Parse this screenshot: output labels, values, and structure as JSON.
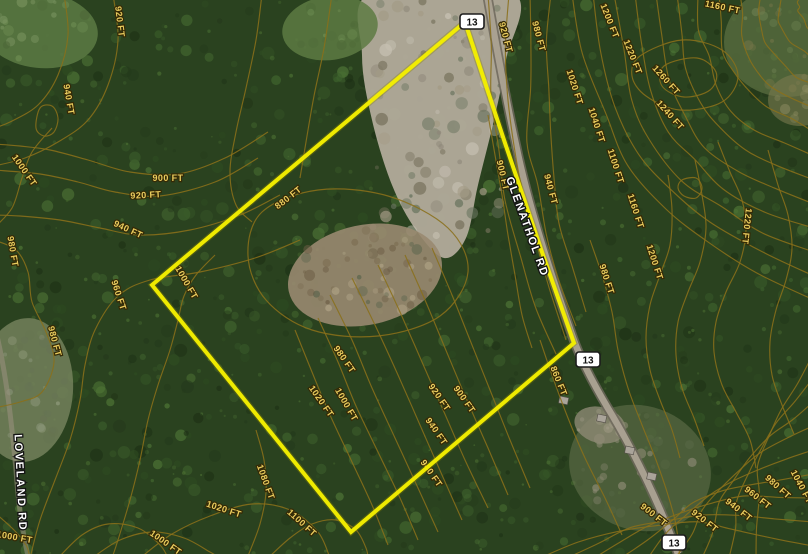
{
  "map": {
    "kind": "satellite-topographic-parcel-map",
    "elevation_unit": "FT",
    "colors": {
      "forest_base": "#2a421f",
      "contour_line": "#8a701a",
      "contour_label_fill": "#e9cc5e",
      "contour_label_outline": "#352a06",
      "boundary_yellow": "#f4ee00",
      "road_fill": "#aca393",
      "road_casing": "#6d675c",
      "shield_fill": "#ffffff",
      "shield_border": "#1c1c1c"
    },
    "route_markers": [
      {
        "text": "13",
        "x": 472,
        "y": 22
      },
      {
        "text": "13",
        "x": 588,
        "y": 360
      },
      {
        "text": "13",
        "x": 674,
        "y": 543
      }
    ],
    "road_labels": [
      {
        "text": "GLENATHOL RD",
        "x": 524,
        "y": 228,
        "rot": 70
      },
      {
        "text": "LOVELAND RD",
        "x": 17,
        "y": 483,
        "rot": 87
      }
    ],
    "boundary": {
      "points": [
        [
          465,
          22
        ],
        [
          505,
          143
        ],
        [
          543,
          255
        ],
        [
          574,
          343
        ],
        [
          351,
          532
        ],
        [
          152,
          285
        ]
      ]
    },
    "contour_labels": [
      {
        "text": "920 FT",
        "x": 117,
        "y": 22,
        "rot": 83
      },
      {
        "text": "940 FT",
        "x": 66,
        "y": 100,
        "rot": 80
      },
      {
        "text": "1000 FT",
        "x": 22,
        "y": 172,
        "rot": 55
      },
      {
        "text": "900 FT",
        "x": 168,
        "y": 181,
        "rot": 0
      },
      {
        "text": "920 FT",
        "x": 146,
        "y": 198,
        "rot": -3
      },
      {
        "text": "940 FT",
        "x": 127,
        "y": 232,
        "rot": 25
      },
      {
        "text": "960 FT",
        "x": 116,
        "y": 296,
        "rot": 72
      },
      {
        "text": "1000 FT",
        "x": 184,
        "y": 284,
        "rot": 60
      },
      {
        "text": "980 FT",
        "x": 10,
        "y": 252,
        "rot": 80
      },
      {
        "text": "980 FT",
        "x": 52,
        "y": 342,
        "rot": 75
      },
      {
        "text": "880 FT",
        "x": 290,
        "y": 200,
        "rot": -38
      },
      {
        "text": "900 FT",
        "x": 500,
        "y": 176,
        "rot": 77
      },
      {
        "text": "940 FT",
        "x": 548,
        "y": 190,
        "rot": 75
      },
      {
        "text": "920 FT",
        "x": 503,
        "y": 38,
        "rot": 75
      },
      {
        "text": "980 FT",
        "x": 536,
        "y": 37,
        "rot": 75
      },
      {
        "text": "1020 FT",
        "x": 572,
        "y": 88,
        "rot": 72
      },
      {
        "text": "1040 FT",
        "x": 594,
        "y": 126,
        "rot": 72
      },
      {
        "text": "1100 FT",
        "x": 613,
        "y": 167,
        "rot": 72
      },
      {
        "text": "1160 FT",
        "x": 633,
        "y": 212,
        "rot": 72
      },
      {
        "text": "1200 FT",
        "x": 652,
        "y": 263,
        "rot": 72
      },
      {
        "text": "1200 FT",
        "x": 607,
        "y": 22,
        "rot": 68
      },
      {
        "text": "1220 FT",
        "x": 630,
        "y": 58,
        "rot": 68
      },
      {
        "text": "1260 FT",
        "x": 664,
        "y": 82,
        "rot": 48
      },
      {
        "text": "1240 FT",
        "x": 668,
        "y": 117,
        "rot": 48
      },
      {
        "text": "1160 FT",
        "x": 722,
        "y": 10,
        "rot": 12
      },
      {
        "text": "1220 FT",
        "x": 744,
        "y": 226,
        "rot": 96
      },
      {
        "text": "980 FT",
        "x": 604,
        "y": 280,
        "rot": 72
      },
      {
        "text": "860 FT",
        "x": 556,
        "y": 382,
        "rot": 68
      },
      {
        "text": "900 FT",
        "x": 652,
        "y": 517,
        "rot": 38
      },
      {
        "text": "920 FT",
        "x": 703,
        "y": 523,
        "rot": 38
      },
      {
        "text": "940 FT",
        "x": 737,
        "y": 512,
        "rot": 38
      },
      {
        "text": "960 FT",
        "x": 756,
        "y": 500,
        "rot": 38
      },
      {
        "text": "980 FT",
        "x": 776,
        "y": 489,
        "rot": 42
      },
      {
        "text": "1040 FT",
        "x": 799,
        "y": 488,
        "rot": 62
      },
      {
        "text": "980 FT",
        "x": 342,
        "y": 361,
        "rot": 55
      },
      {
        "text": "1020 FT",
        "x": 319,
        "y": 403,
        "rot": 55
      },
      {
        "text": "1000 FT",
        "x": 344,
        "y": 406,
        "rot": 60
      },
      {
        "text": "920 FT",
        "x": 437,
        "y": 399,
        "rot": 55
      },
      {
        "text": "900 FT",
        "x": 462,
        "y": 401,
        "rot": 55
      },
      {
        "text": "940 FT",
        "x": 434,
        "y": 433,
        "rot": 55
      },
      {
        "text": "940 FT",
        "x": 429,
        "y": 475,
        "rot": 55
      },
      {
        "text": "1080 FT",
        "x": 263,
        "y": 483,
        "rot": 70
      },
      {
        "text": "1100 FT",
        "x": 300,
        "y": 525,
        "rot": 42
      },
      {
        "text": "1020 FT",
        "x": 223,
        "y": 512,
        "rot": 18
      },
      {
        "text": "1000 FT",
        "x": 164,
        "y": 545,
        "rot": 35
      },
      {
        "text": "1000 FT",
        "x": 14,
        "y": 540,
        "rot": 10
      }
    ]
  }
}
